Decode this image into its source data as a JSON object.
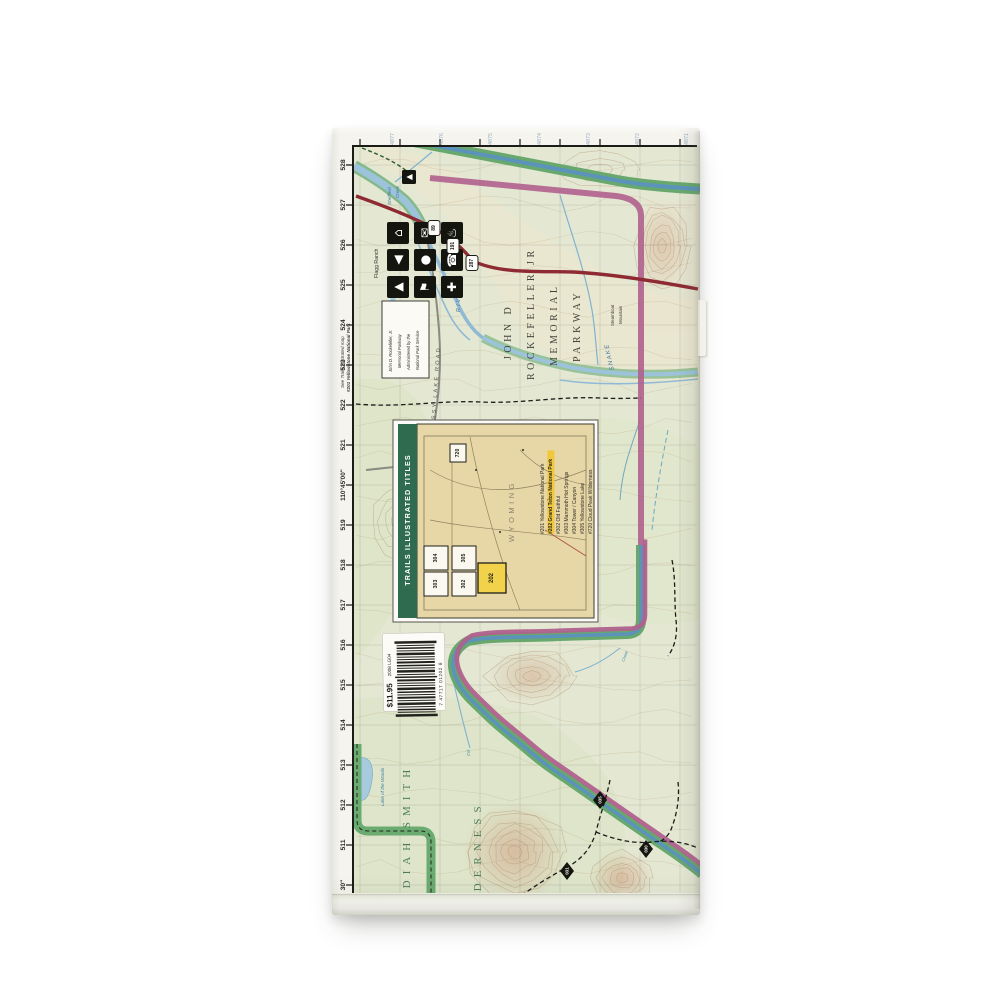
{
  "product": {
    "price": "$11.95",
    "edition_code": "2008 LG04",
    "barcode_digits": "7 47717 01202 8"
  },
  "margins": {
    "see_note_line1": "See Trails Illustrated map",
    "see_note_line2": "#201 Yellowstone National Park",
    "easting_labels": [
      "30\"",
      "511",
      "512",
      "513",
      "514",
      "515",
      "516",
      "517",
      "518",
      "519",
      "110°45'00\"",
      "521",
      "522",
      "523",
      "524",
      "525",
      "526",
      "527",
      "528"
    ],
    "northing_labels": [
      "4877",
      "4876",
      "4875",
      "4874",
      "4873",
      "4872",
      "4871"
    ]
  },
  "map_labels": {
    "parkway": [
      "JOHN D",
      "ROCKEFELLER JR",
      "MEMORIAL",
      "PARKWAY"
    ],
    "wilderness_line1": "JEDEDIAH SMITH",
    "wilderness_line2": "WILDERNESS",
    "snake": "SNAKE",
    "river": "RIVER",
    "sheffield_1": "Sheffield",
    "sheffield_2": "Creek",
    "lake_of_the_woods": "Lake of the Woods",
    "creek_small": "Creek",
    "crk_small": "Crk",
    "flagg_ranch": "Flagg Ranch",
    "steamboat_1": "Steamboat",
    "steamboat_2": "Mountain",
    "grassy_lake_road": "GRASSY LAKE ROAD",
    "admin_note": [
      "John D. Rockefeller, Jr.",
      "Memorial Parkway",
      "Administered by the",
      "National Park Service"
    ]
  },
  "highway_shields": [
    "89",
    "191",
    "287"
  ],
  "trail_markers": [
    "035",
    "030",
    "031"
  ],
  "facility_icons": [
    {
      "name": "lodging-icon",
      "glyph": "⌂"
    },
    {
      "name": "mail-icon",
      "glyph": "✉"
    },
    {
      "name": "hot-spring-icon",
      "glyph": "♨"
    },
    {
      "name": "boat-launch-icon",
      "glyph": "◀"
    },
    {
      "name": "ranger-station-icon",
      "glyph": "●"
    },
    {
      "name": "telephone-icon",
      "glyph": "☎"
    },
    {
      "name": "campground-icon",
      "glyph": "▲"
    },
    {
      "name": "flag-station-icon",
      "glyph": "⚑"
    },
    {
      "name": "first-aid-icon",
      "glyph": "✚"
    }
  ],
  "trailhead_icon": {
    "name": "trailhead-icon",
    "glyph": "▲"
  },
  "inset": {
    "title": "TRAILS ILLUSTRATED TITLES",
    "state": "WYOMING",
    "boxes": [
      "304",
      "305",
      "303",
      "302",
      "720",
      "202"
    ],
    "highlighted_box": "202",
    "titles": [
      {
        "num": "#201",
        "name": "Yellowstone National Park",
        "highlight": false
      },
      {
        "num": "#202",
        "name": "Grand Teton National Park",
        "highlight": true
      },
      {
        "num": "#302",
        "name": "Old Faithful",
        "highlight": false
      },
      {
        "num": "#303",
        "name": "Mammoth Hot Springs",
        "highlight": false
      },
      {
        "num": "#304",
        "name": "Tower / Canyon",
        "highlight": false
      },
      {
        "num": "#305",
        "name": "Yellowstone Lake",
        "highlight": false
      },
      {
        "num": "#720",
        "name": "Cloud Peak Wilderness",
        "highlight": false
      }
    ]
  },
  "colors": {
    "map_base": "#e4e8d3",
    "park_boundary_green": "#68a86d",
    "boundary_blue": "#5b93bb",
    "parkway_magenta": "#b0618e",
    "highway_red": "#8e2a32",
    "inset_tan": "#e7d7a6",
    "inset_green_bar": "#2f6b4e",
    "highlight_yellow": "#f2d24b",
    "wilderness_green": "#4e7d57",
    "water_blue": "#8fb9d4"
  }
}
